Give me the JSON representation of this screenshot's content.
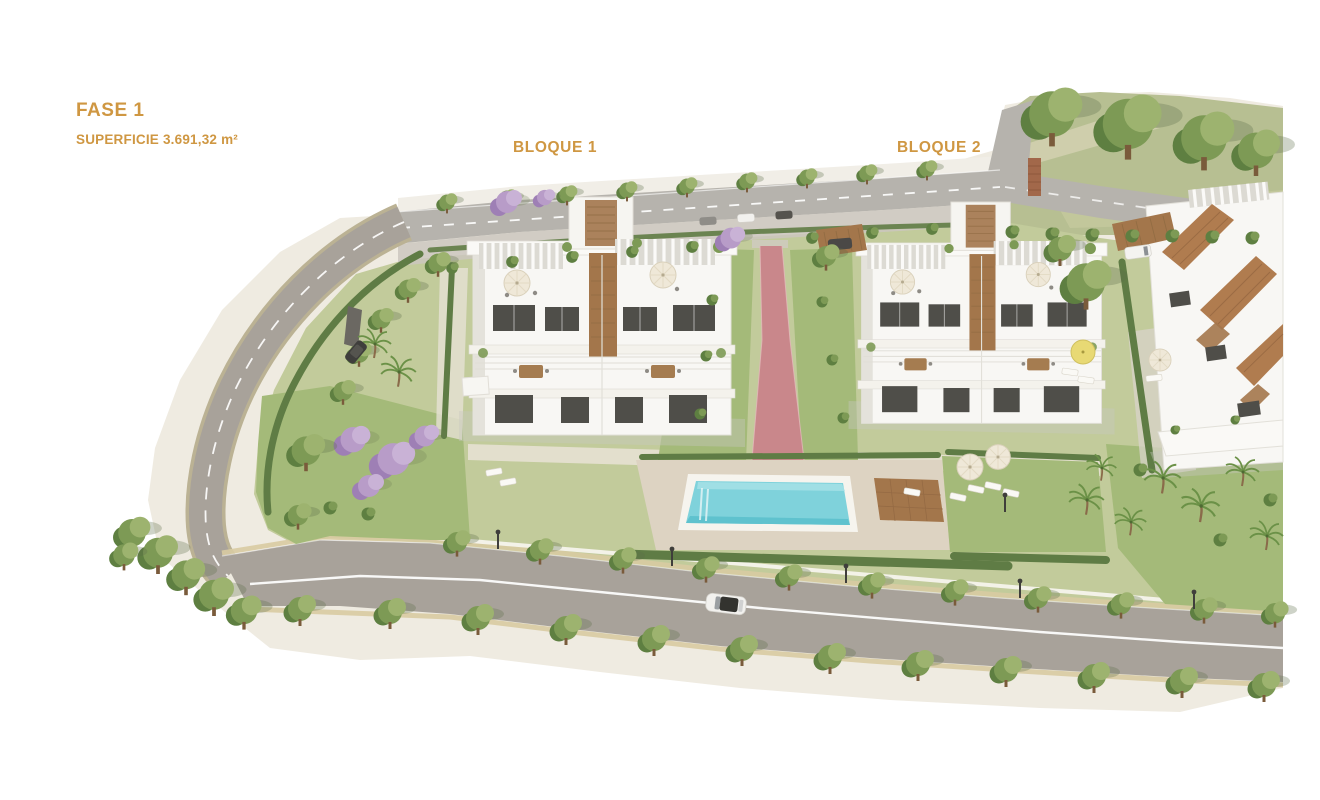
{
  "labels": {
    "phase_title": "FASE 1",
    "phase_area": "SUPERFICIE 3.691,32 m²",
    "block1": "BLOQUE 1",
    "block2": "BLOQUE 2"
  },
  "scene": {
    "type": "aerial-architectural-render",
    "elements": [
      "apartment-building-bloque-1",
      "apartment-building-bloque-2",
      "partial-building-right",
      "swimming-pool",
      "wooden-sun-deck",
      "pink-garden-path",
      "perimeter-road",
      "top-road-with-parking",
      "street-trees",
      "palm-trees",
      "jacaranda-trees",
      "sun-umbrellas",
      "sun-loungers",
      "white-car",
      "dark-suv",
      "hill-with-large-trees",
      "carports",
      "street-lamps"
    ]
  },
  "colors": {
    "label_gold": "#CF9742",
    "apron": "#EFEBE1",
    "hill": "#B7BF92",
    "road": "#A8A29A",
    "road_top": "#B6B3AD",
    "site_grass": "#C2CB9B",
    "lawn": "#A4BA79",
    "hedge": "#5F7C45",
    "tree_dark": "#5E7F41",
    "tree_mid": "#7D9A55",
    "tree_light": "#9DB36F",
    "jacaranda": "#B89CC8",
    "jacaranda_dark": "#9E7FB5",
    "pool_water": "#7FD2DB",
    "pool_water_deep": "#5FC2CE",
    "deck_paving": "#DDD3C2",
    "deck_wood": "#A3764B",
    "path_pink": "#C9878B",
    "building_white": "#F8F7F4",
    "terracotta": "#B07C4F",
    "window_glass": "#4F4E49",
    "umbrella_cream": "#EFE8D8"
  }
}
